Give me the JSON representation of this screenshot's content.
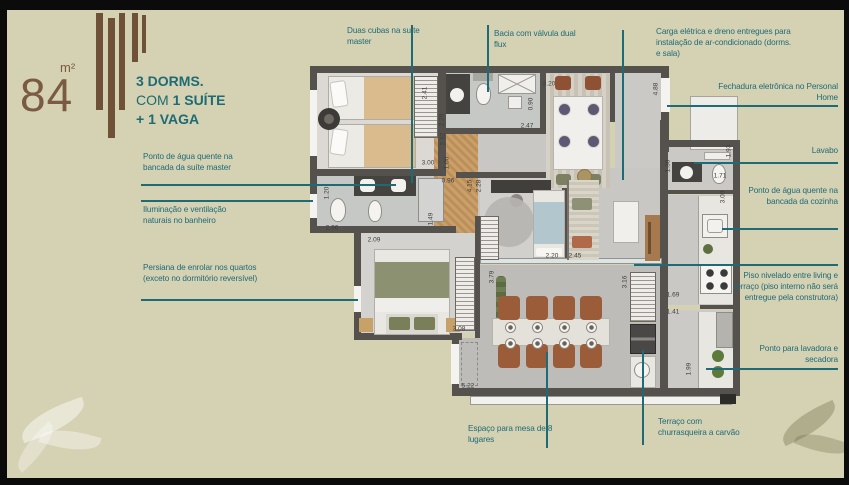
{
  "header": {
    "area_value": "84",
    "area_unit": "m²",
    "title": {
      "line1": "3 DORMS.",
      "line2_prefix": "COM ",
      "line2_bold": "1 SUÍTE",
      "line3": "+ 1 VAGA"
    }
  },
  "colors": {
    "background": "#d5d1b3",
    "accent_teal": "#1e6b76",
    "brand_brown": "#6f5138",
    "wall": "#55524e"
  },
  "callouts": [
    {
      "id": "duas-cubas",
      "text": "Duas cubas na suíte master",
      "x": 347,
      "y": 26,
      "w": 80,
      "align": "left",
      "line": {
        "o": "v",
        "x": 411,
        "y1": 25,
        "y2": 183
      }
    },
    {
      "id": "bacia-dual-flux",
      "text": "Bacia com válvula dual flux",
      "x": 494,
      "y": 29,
      "w": 92,
      "align": "left",
      "line": {
        "o": "v",
        "x": 487,
        "y1": 25,
        "y2": 92
      }
    },
    {
      "id": "carga-eletrica",
      "text": "Carga elétrica e dreno entregues para instalação de ar-condicionado (dorms. e sala)",
      "x": 656,
      "y": 27,
      "w": 140,
      "align": "left",
      "line": {
        "o": "v",
        "x": 622,
        "y1": 30,
        "y2": 180
      }
    },
    {
      "id": "fechadura-eletronica",
      "text": "Fechadura eletrônica no Personal Home",
      "x": 712,
      "y": 82,
      "w": 126,
      "align": "right",
      "line": {
        "o": "h",
        "y": 105,
        "x1": 667,
        "x2": 838
      }
    },
    {
      "id": "lavabo",
      "text": "Lavabo",
      "x": 738,
      "y": 146,
      "w": 100,
      "align": "right",
      "line": {
        "o": "h",
        "y": 162,
        "x1": 694,
        "x2": 838
      }
    },
    {
      "id": "agua-quente-cozinha",
      "text": "Ponto de água quente na bancada da cozinha",
      "x": 748,
      "y": 186,
      "w": 90,
      "align": "right",
      "line": {
        "o": "h",
        "y": 228,
        "x1": 722,
        "x2": 838
      }
    },
    {
      "id": "piso-nivelado",
      "text": "Piso nivelado entre living e terraço (piso interno não será entregue pela construtora)",
      "x": 726,
      "y": 271,
      "w": 112,
      "align": "right",
      "line": {
        "o": "h",
        "y": 264,
        "x1": 634,
        "x2": 838
      }
    },
    {
      "id": "lavadora-secadora",
      "text": "Ponto para lavadora e secadora",
      "x": 748,
      "y": 344,
      "w": 90,
      "align": "right",
      "line": {
        "o": "h",
        "y": 368,
        "x1": 706,
        "x2": 838
      }
    },
    {
      "id": "mesa-8-lugares",
      "text": "Espaço para mesa de 8 lugares",
      "x": 468,
      "y": 424,
      "w": 108,
      "align": "left",
      "line": {
        "o": "v",
        "x": 546,
        "y1": 352,
        "y2": 448
      }
    },
    {
      "id": "terraco-churrasqueira",
      "text": "Terraço com churrasqueira a carvão",
      "x": 658,
      "y": 417,
      "w": 92,
      "align": "left",
      "line": {
        "o": "v",
        "x": 642,
        "y1": 350,
        "y2": 445
      }
    },
    {
      "id": "agua-quente-suite",
      "text": "Ponto de água quente na bancada da suíte master",
      "x": 143,
      "y": 152,
      "w": 112,
      "align": "left",
      "line": {
        "o": "h",
        "y": 184,
        "x1": 141,
        "x2": 396
      }
    },
    {
      "id": "iluminacao-banheiro",
      "text": "Iluminação e ventilação naturais no banheiro",
      "x": 143,
      "y": 205,
      "w": 112,
      "align": "left",
      "line": {
        "o": "h",
        "y": 200,
        "x1": 141,
        "x2": 313
      }
    },
    {
      "id": "persiana-enrolar",
      "text": "Persiana de enrolar nos quartos (exceto no dormitório reversível)",
      "x": 143,
      "y": 263,
      "w": 115,
      "align": "left",
      "line": {
        "o": "h",
        "y": 299,
        "x1": 141,
        "x2": 358
      }
    }
  ],
  "dimensions": [
    {
      "t": "2.41",
      "x": 425,
      "y": 93,
      "o": "v"
    },
    {
      "t": "2.29",
      "x": 442,
      "y": 120,
      "o": "v"
    },
    {
      "t": "2.62",
      "x": 443,
      "y": 139,
      "o": "v"
    },
    {
      "t": "3.00",
      "x": 428,
      "y": 163,
      "o": "h"
    },
    {
      "t": "1.00",
      "x": 447,
      "y": 163,
      "o": "v"
    },
    {
      "t": "0.96",
      "x": 448,
      "y": 181,
      "o": "h"
    },
    {
      "t": "1.20",
      "x": 327,
      "y": 193,
      "o": "v"
    },
    {
      "t": "2.96",
      "x": 332,
      "y": 228,
      "o": "h"
    },
    {
      "t": "1.49",
      "x": 431,
      "y": 219,
      "o": "v"
    },
    {
      "t": "2.09",
      "x": 374,
      "y": 240,
      "o": "h"
    },
    {
      "t": "4.15",
      "x": 470,
      "y": 186,
      "o": "v"
    },
    {
      "t": "2.28",
      "x": 479,
      "y": 186,
      "o": "v"
    },
    {
      "t": "0.90",
      "x": 531,
      "y": 104,
      "o": "v"
    },
    {
      "t": "2.47",
      "x": 527,
      "y": 126,
      "o": "h"
    },
    {
      "t": "3.20",
      "x": 549,
      "y": 84,
      "o": "h"
    },
    {
      "t": "4.88",
      "x": 656,
      "y": 89,
      "o": "v"
    },
    {
      "t": "1.93",
      "x": 729,
      "y": 151,
      "o": "v"
    },
    {
      "t": "1.71",
      "x": 720,
      "y": 176,
      "o": "h"
    },
    {
      "t": "1.30",
      "x": 668,
      "y": 166,
      "o": "v"
    },
    {
      "t": "3.00",
      "x": 723,
      "y": 197,
      "o": "v"
    },
    {
      "t": "2.20",
      "x": 552,
      "y": 256,
      "o": "h"
    },
    {
      "t": "2.45",
      "x": 575,
      "y": 256,
      "o": "h"
    },
    {
      "t": "3.16",
      "x": 625,
      "y": 282,
      "o": "v"
    },
    {
      "t": "3.79",
      "x": 492,
      "y": 277,
      "o": "v"
    },
    {
      "t": "3.08",
      "x": 459,
      "y": 329,
      "o": "h"
    },
    {
      "t": "1.69",
      "x": 673,
      "y": 295,
      "o": "h"
    },
    {
      "t": "1.41",
      "x": 673,
      "y": 312,
      "o": "h"
    },
    {
      "t": "1.99",
      "x": 689,
      "y": 369,
      "o": "v"
    },
    {
      "t": "5.22",
      "x": 468,
      "y": 386,
      "o": "h"
    }
  ]
}
